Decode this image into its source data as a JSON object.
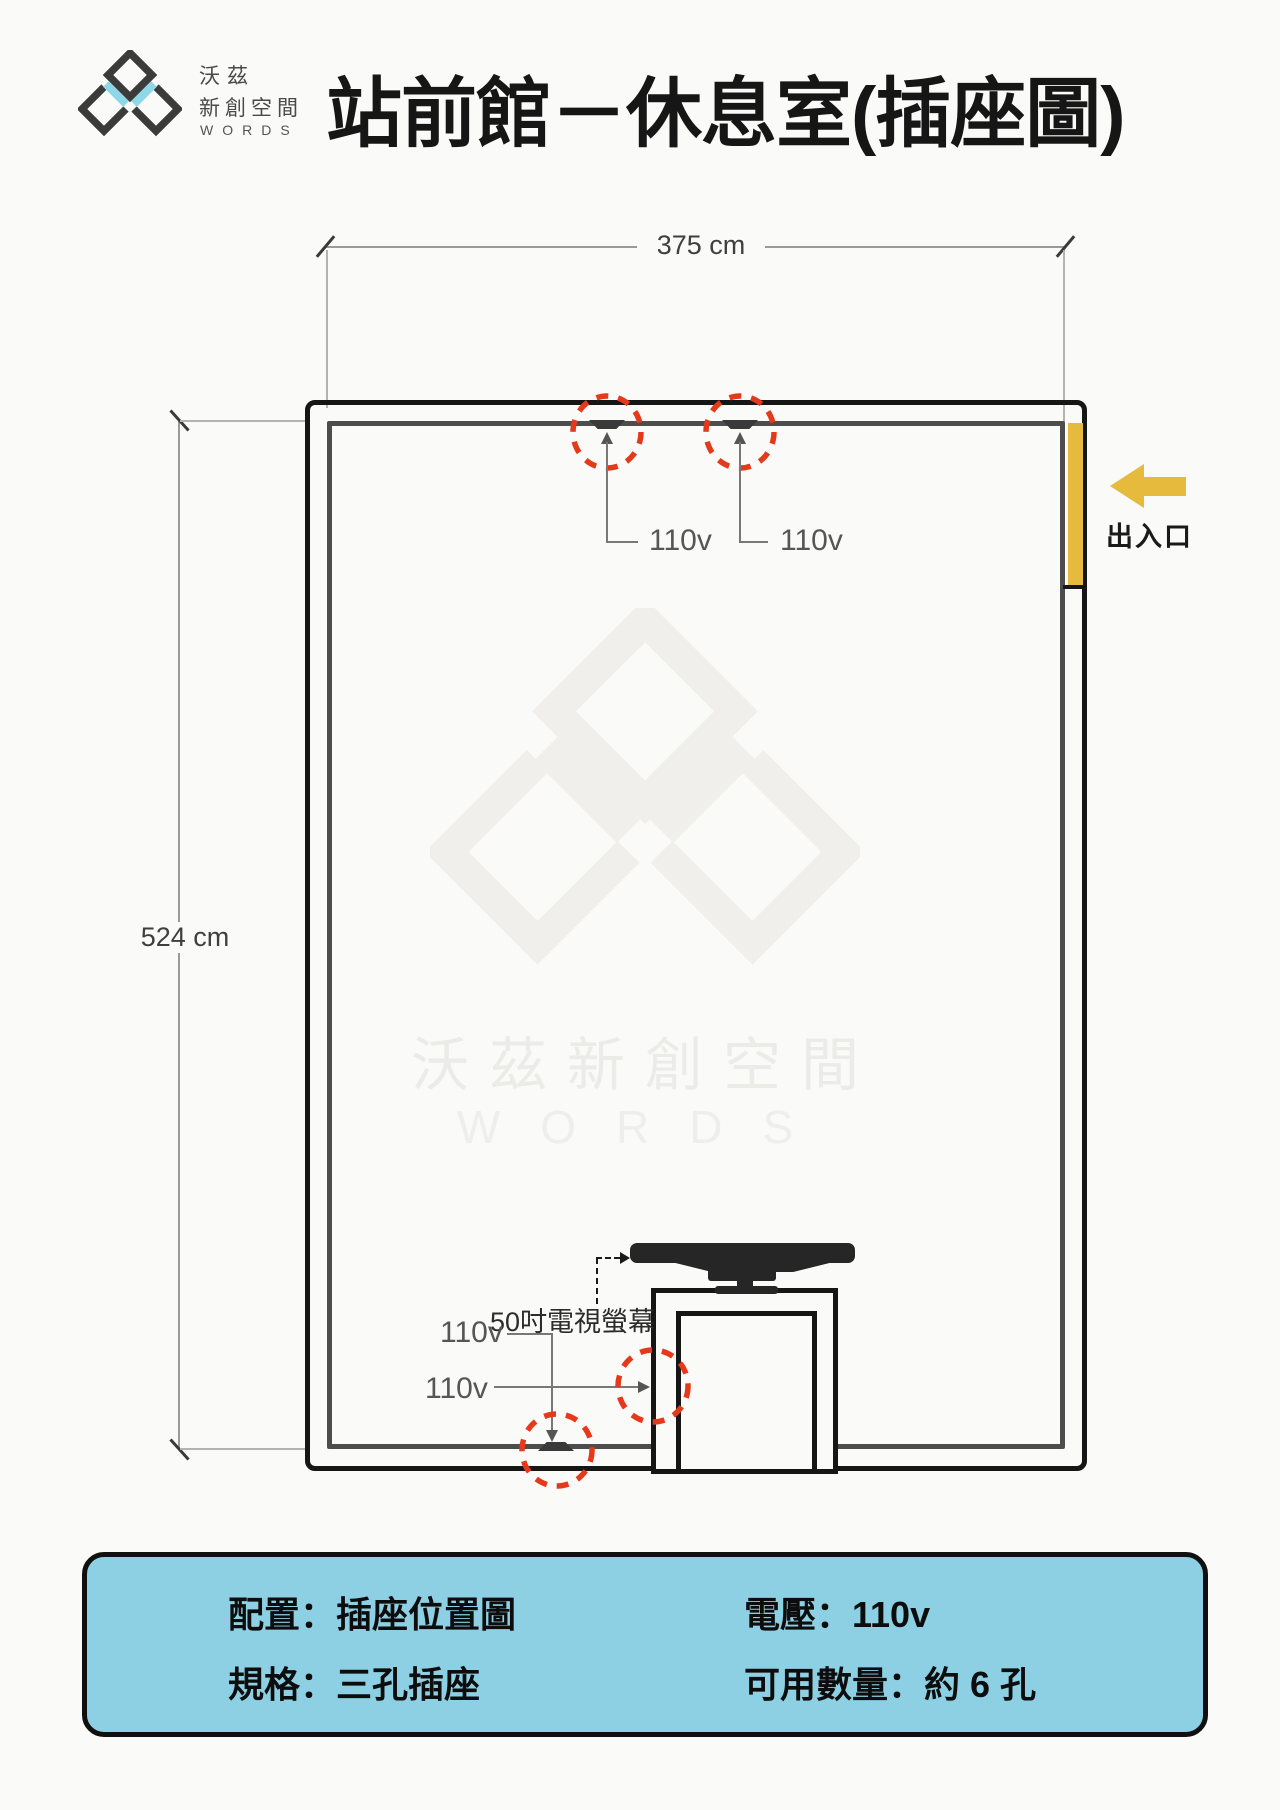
{
  "header": {
    "logo": {
      "line1": "沃茲",
      "line2": "新創空間",
      "line3": "WORDS"
    },
    "title": "站前館－休息室(插座圖)"
  },
  "floor_plan": {
    "dimensions": {
      "width_label": "375 cm",
      "height_label": "524 cm"
    },
    "entrance": {
      "label": "出入口"
    },
    "outlet_labels": [
      "110v",
      "110v",
      "110v",
      "110v"
    ],
    "tv_label": "50吋電視螢幕",
    "watermark": {
      "name_cjk": "沃茲新創空間",
      "name_en": "WORDS"
    }
  },
  "info_box": {
    "items": [
      "配置：插座位置圖",
      "規格：三孔插座",
      "電壓：110v",
      "可用數量：約 6 孔"
    ]
  },
  "colors": {
    "accent_red": "#e5391b",
    "entrance_yellow": "#e6ba3d",
    "info_blue": "#8dd0e4",
    "logo_cyan": "#8ed7e6",
    "wall_dark": "#161616",
    "wall_gray": "#4d4d4d",
    "background": "#fafaf8"
  }
}
